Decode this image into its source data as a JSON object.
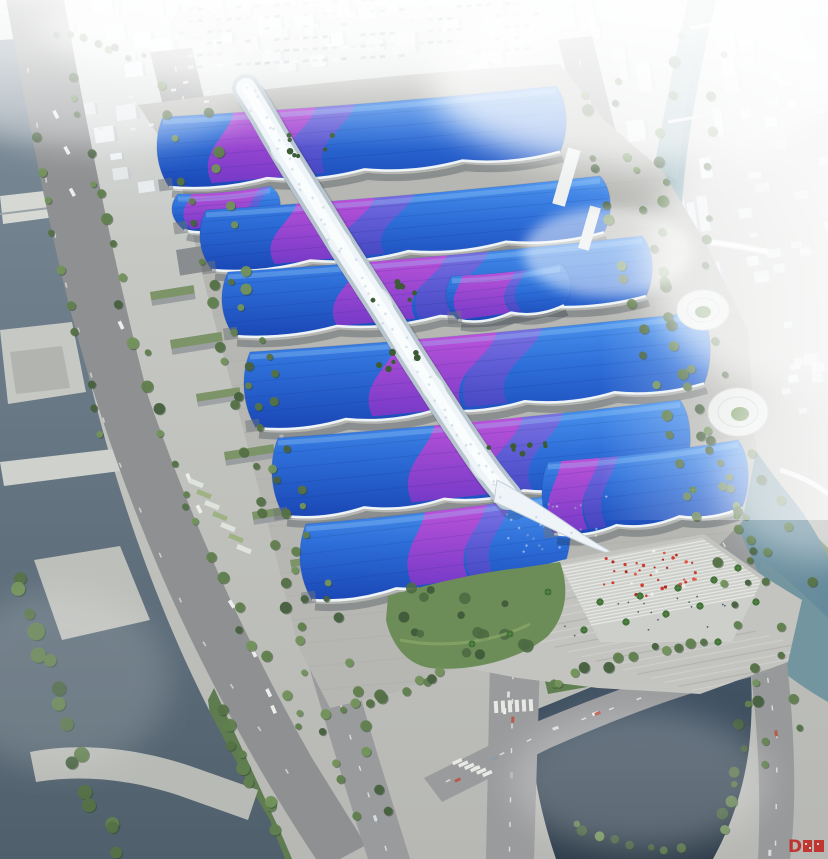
{
  "scene": {
    "type_label": "aerial architectural rendering",
    "subject_label": "Bird's-eye rendering of a riverside exhibition and convention center: a white serpentine central canopy spine crosses rows of exhibition halls with blue roofs swept by purple-magenta wave bands, surrounded by tree-lined boulevards, canals, bridges, parking lots and a hazy white city skyline",
    "watermark": {
      "text": "D",
      "color": "#c2241e"
    }
  },
  "palette": {
    "roof_blue_bright": "#4e97f0",
    "roof_blue_mid": "#2e6fd9",
    "roof_blue_deep": "#1a47b6",
    "roof_cyan_sheen": "#8cc6f8",
    "roof_purple": "#7d38c8",
    "roof_magenta": "#c84fd8",
    "spine_white": "#eef4f8",
    "spine_shade": "#b7c5cf",
    "water_dark": "#2e3d4a",
    "water_dark_light": "#46586a",
    "water_teal": "#64899a",
    "water_teal_light": "#8fb0b8",
    "water_canal": "#6b7d8b",
    "concrete": "#b5b6b2",
    "plaza": "#c3c4c0",
    "road": "#98999b",
    "tree_green": "#567247",
    "tree_green_dark": "#3c5838",
    "lawn_green": "#7f9f66",
    "haze": "#eef1f3",
    "crowd_red": "#cf3a30"
  }
}
